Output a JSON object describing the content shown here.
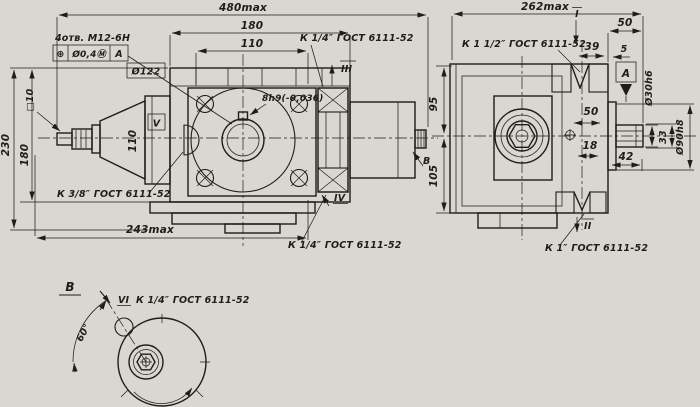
{
  "drawing": {
    "kind": "technical drawing, hydraulic pump overall-dimension drawing",
    "paper_color": "#d8d7d1",
    "ink_color": "#1e1d1a",
    "thread_standard": "ГОСТ 6111-52",
    "front_view": {
      "dim_overall_length": "480max",
      "dim_flange_width": "180",
      "dim_bolt_spacing": "110",
      "dim_total_height": "230",
      "dim_flange_height": "180",
      "dim_shaft_square": "□10",
      "dim_cone": "110",
      "dim_bolt_circle": "Ø122",
      "dim_keyway": "8h9(-0,036)",
      "dim_base_length": "243max",
      "note_holes": "4отв. М12-6Н",
      "fcf_symbol": "⊕",
      "fcf_tolerance": "Ø0,4Ⓜ",
      "fcf_datum": "А",
      "port_top_label": "К 1/4″ ГОСТ 6111-52",
      "port_top_marker": "III",
      "port_bottom_label": "К 1/4″ ГОСТ 6111-52",
      "port_bottom_marker": "IV",
      "port_drain_label": "К 3/8″ ГОСТ 6111-52",
      "port_drain_marker": "V",
      "view_direction_arrow": "В"
    },
    "side_view": {
      "dim_overall_width": "262max",
      "dim_top_to_axis": "95",
      "dim_axis_to_bottom": "105",
      "dim_shaft_overhang": "50",
      "dim_port_offset": "39",
      "dim_spigot_lip": "5",
      "dim_port_top_height": "50",
      "dim_port_bottom_height": "18",
      "dim_flange_thickness": "42",
      "dim_shaft_flat": "33",
      "dim_shaft_diameter": "Ø30h6",
      "dim_spigot_diameter": "Ø90h8",
      "datum_label": "А",
      "port_top_label": "К 1 1/2″ ГОСТ 6111-52",
      "port_top_marker": "I",
      "port_bottom_label": "К 1″ ГОСТ 6111-52",
      "port_bottom_marker": "II"
    },
    "detail_view": {
      "view_label": "В",
      "port_label": "К 1/4″ ГОСТ 6111-52",
      "port_marker": "VI",
      "dim_angle": "60°"
    }
  }
}
